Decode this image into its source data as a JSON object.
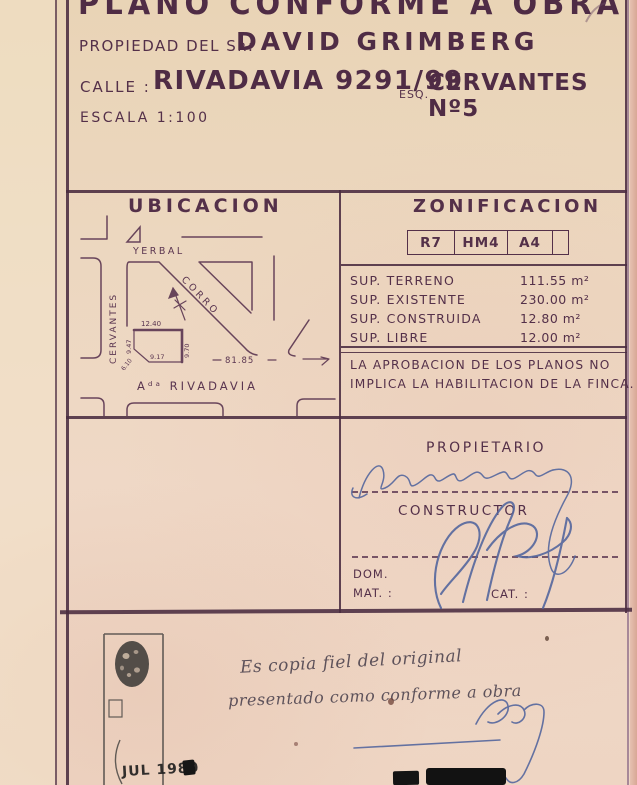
{
  "document": {
    "title": "PLANO CONFORME A OBRA",
    "owner_label": "PROPIEDAD DEL Sʀ:",
    "owner_name": "DAVID GRIMBERG",
    "street_label": "CALLE :",
    "street_value": "RIVADAVIA 9291/99",
    "street_esq_label": "ESQ.",
    "street_corner": "CERVANTES Nº5",
    "scale_label": "ESCALA 1:100"
  },
  "ubicacion": {
    "title": "UBICACION",
    "street_top": "YERBAL",
    "street_left": "CERVANTES",
    "street_diagonal": "CORRO",
    "street_bottom": "Aᵈᵃ RIVADAVIA",
    "frontage": "81.85",
    "lot": {
      "front": "12.40",
      "left": "9.47",
      "right": "9.70",
      "bottom": "9.17",
      "ochava": "6.10"
    }
  },
  "zonificacion": {
    "title": "ZONIFICACION",
    "codes": [
      "R7",
      "HM4",
      "A4"
    ],
    "rows": [
      {
        "label": "SUP. TERRENO",
        "value": "111.55 m²"
      },
      {
        "label": "SUP. EXISTENTE",
        "value": "230.00 m²"
      },
      {
        "label": "SUP. CONSTRUIDA",
        "value": "12.80 m²"
      },
      {
        "label": "SUP. LIBRE",
        "value": "12.00 m²"
      }
    ],
    "note_line1": "LA APROBACION DE LOS PLANOS NO",
    "note_line2": "IMPLICA LA HABILITACION  DE LA FINCA."
  },
  "firmas": {
    "propietario_label": "PROPIETARIO",
    "constructor_label": "CONSTRUCTOR",
    "dom_label": "DOM.",
    "mat_label": "MAT. :",
    "cat_label": "CAT. :"
  },
  "footer": {
    "stamp_date": "JUL 1980",
    "note_line1": "Es copia fiel del original",
    "note_line2": "presentado como conforme a obra"
  },
  "colors": {
    "ink": "#543049",
    "paper": "#ecd6bf",
    "signature_blue": "#55679e",
    "stamp_black": "#1d1d1d"
  }
}
